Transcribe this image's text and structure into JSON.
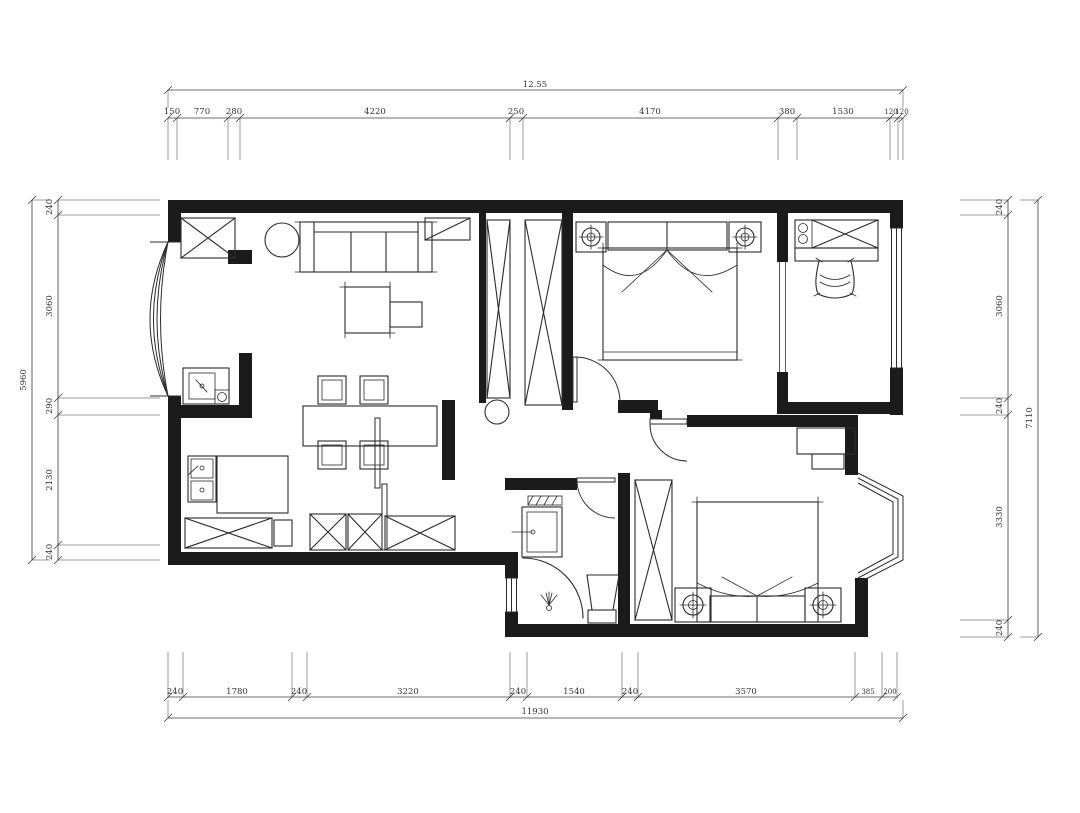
{
  "drawing": {
    "type": "apartment-floor-plan",
    "background": "#ffffff",
    "line_color": "#1b1b1b",
    "dimensions": {
      "top": {
        "total": "12.55",
        "segments": [
          "150",
          "770",
          "280",
          "4220",
          "250",
          "4170",
          "380",
          "1530",
          "120",
          "120"
        ]
      },
      "bottom": {
        "total": "11930",
        "segments": [
          "240",
          "1780",
          "240",
          "3220",
          "240",
          "1540",
          "240",
          "3570",
          "385",
          "200"
        ]
      },
      "left": {
        "total": "5960",
        "segments": [
          "240",
          "3060",
          "290",
          "2130",
          "240"
        ]
      },
      "right": {
        "total": "7110",
        "segments": [
          "240",
          "3060",
          "240",
          "3330",
          "240"
        ]
      }
    },
    "elements": [
      "bay-window-living",
      "entry-cabinet",
      "plant",
      "sofa",
      "coffee-table",
      "side-table",
      "dining-table",
      "dining-chairs",
      "kitchen-sink",
      "kitchen-counter",
      "kitchen-cabinets",
      "sliding-door",
      "wash-basin",
      "tv-cabinets",
      "hall-closets",
      "master-bed",
      "nightstands",
      "study-desk",
      "study-chair",
      "study-window",
      "bathroom-sink",
      "shower",
      "toilet",
      "bathroom-window",
      "wardrobe",
      "second-bed",
      "bedroom-desk",
      "bay-window-bedroom"
    ]
  }
}
